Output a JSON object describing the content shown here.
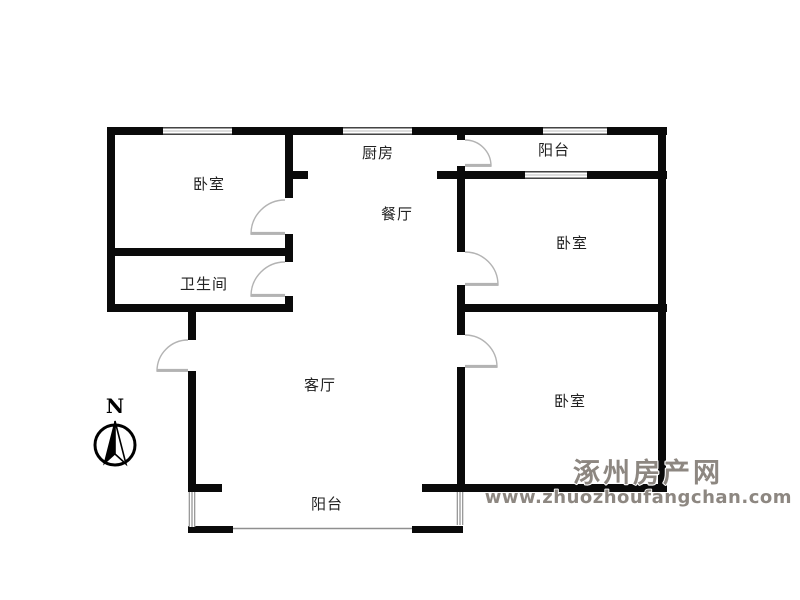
{
  "rooms": [
    {
      "name": "bedroom-1",
      "label": "卧室"
    },
    {
      "name": "kitchen",
      "label": "厨房"
    },
    {
      "name": "balcony-top",
      "label": "阳台"
    },
    {
      "name": "dining-room",
      "label": "餐厅"
    },
    {
      "name": "bedroom-2",
      "label": "卧室"
    },
    {
      "name": "bathroom",
      "label": "卫生间"
    },
    {
      "name": "living-room",
      "label": "客厅"
    },
    {
      "name": "bedroom-3",
      "label": "卧室"
    },
    {
      "name": "balcony-bottom",
      "label": "阳台"
    }
  ],
  "compass": {
    "north_label": "N"
  },
  "watermark": {
    "site_name": "涿州房产网",
    "site_url": "www.zhuozhoufangchan.com"
  },
  "colors": {
    "wall": "#0a0a0a",
    "door": "#b3b3b3",
    "window": "#8f8f8f",
    "window_mid": "#d2d2d2",
    "label": "#222222",
    "watermark": "#8d8781",
    "background": "#ffffff"
  }
}
